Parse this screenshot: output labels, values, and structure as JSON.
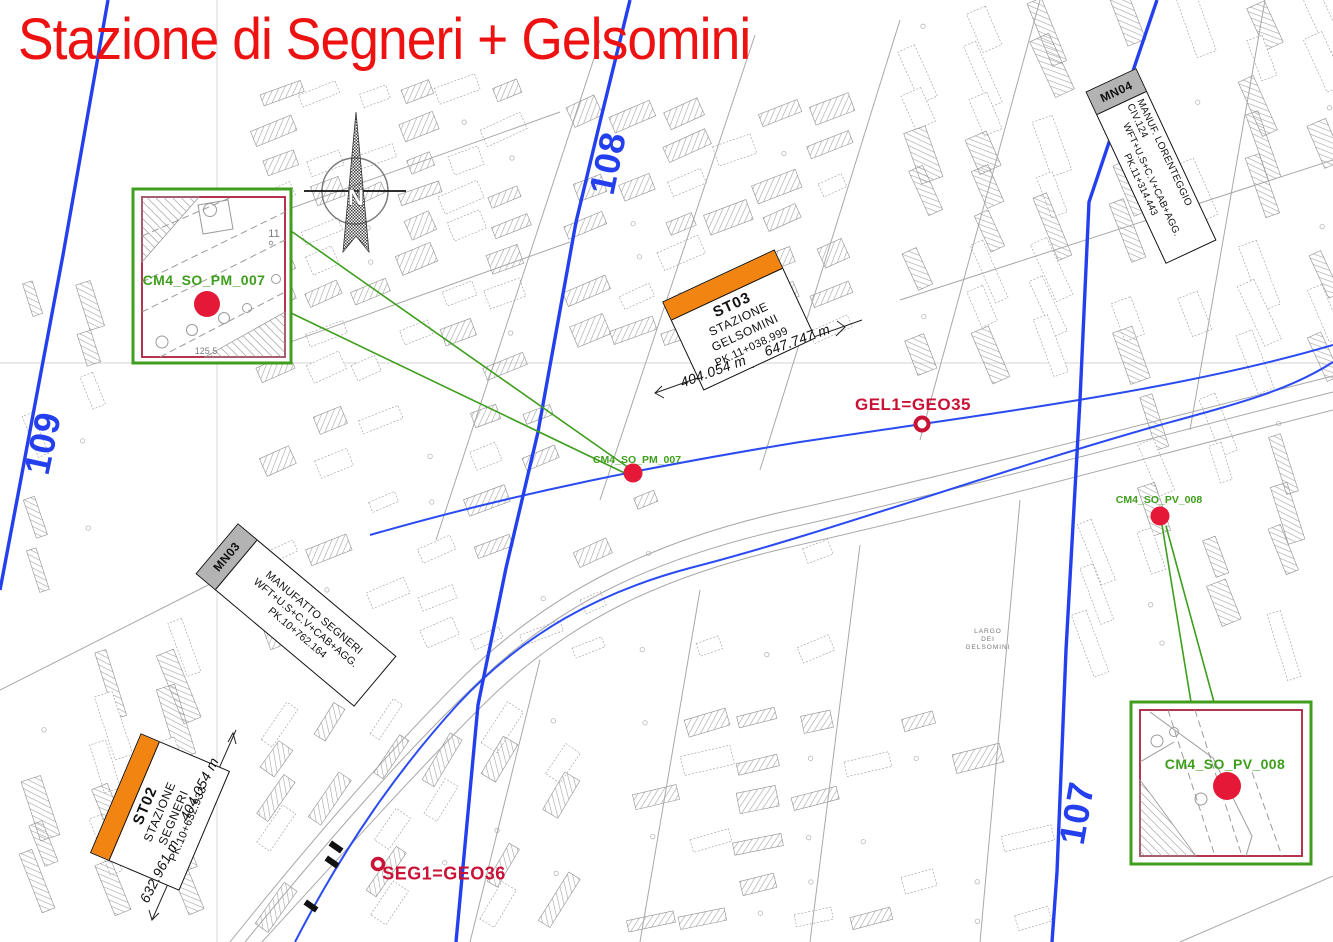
{
  "title": {
    "text": "Stazione di Segneri + Gelsomini"
  },
  "north": {
    "label": "N"
  },
  "section_lines": {
    "left": "109",
    "middle": "108",
    "right": "107"
  },
  "station_boxes": [
    {
      "code": "ST03",
      "line1": "STAZIONE",
      "line2": "GELSOMINI",
      "pk": "PK.11+038.999"
    },
    {
      "code": "ST02",
      "line1": "STAZIONE",
      "line2": "SEGNERI",
      "pk": "PK.10+632.933"
    }
  ],
  "manufatto_boxes": [
    {
      "code": "MN03",
      "line1": "MANUFATTO  SEGNERI",
      "line2": "WFT+U.S+C.V+CAB+AGG.",
      "pk": "PK.10+762.164"
    },
    {
      "code": "MN04",
      "line1": "MANUF.  LORENTEGGIO  CIV.124",
      "line2": "WFT+U.S+C.V+CAB+AGG.",
      "pk": "PK.11+314.443"
    }
  ],
  "dimensions": {
    "gelsomini_a": "404.054 m",
    "gelsomini_b": "647.747 m",
    "segneri_a": "632.961 m",
    "segneri_b": "404.054 m"
  },
  "survey_points": [
    {
      "label": "GEL1=GEO35"
    },
    {
      "label": "SEG1=GEO36"
    }
  ],
  "core_points": [
    {
      "label": "CM4_SO_PM_007"
    },
    {
      "label": "CM4_SO_PV_008"
    }
  ],
  "insets": [
    {
      "label": "CM4_SO_PM_007",
      "note_parcel": "11",
      "note_area": "125.5"
    },
    {
      "label": "CM4_SO_PV_008"
    }
  ],
  "map_labels": {
    "largo_1": "LARGO",
    "largo_2": "DEI",
    "largo_3": "GELSOMINI"
  },
  "colors": {
    "title_red": "#ee1111",
    "survey_crimson": "#c91235",
    "core_green": "#3f9e1e",
    "marker_red": "#e51937",
    "section_blue": "#2440ee",
    "station_orange": "#f28511",
    "manufatto_gray": "#b3b3b3"
  }
}
